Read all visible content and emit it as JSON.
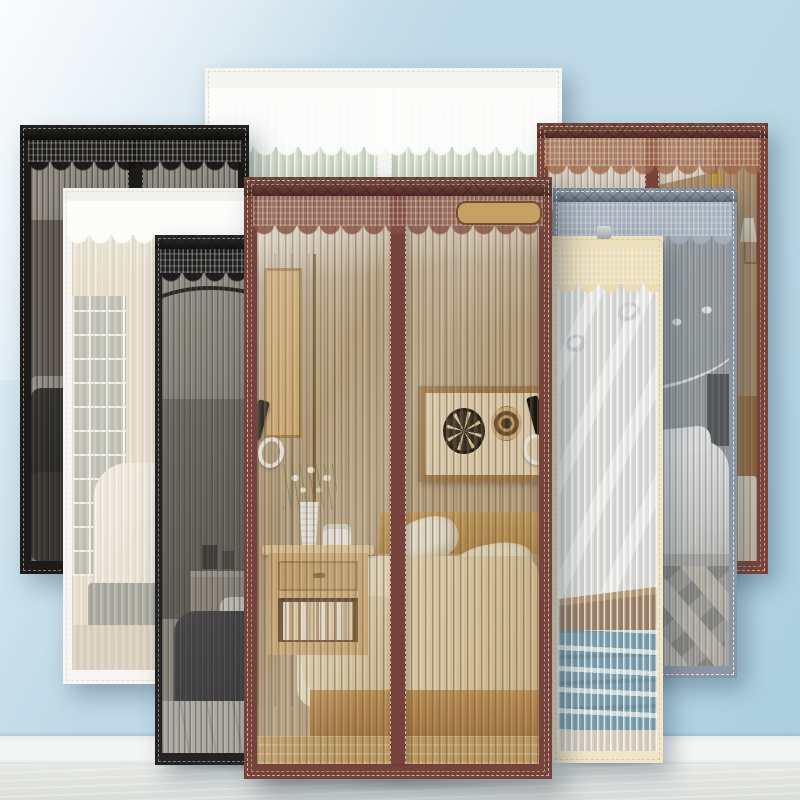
{
  "image_type": "product photo collage",
  "product": {
    "name": "Magnetic lace-trim mesh screen doors shown in multiple colors",
    "variants_shown": [
      "wide white lace",
      "black",
      "white",
      "dark gray",
      "reddish brown",
      "blue gray",
      "beige",
      "coffee brown (front)"
    ]
  },
  "scene": {
    "setting": "light blue wall, white baseboard, pale wood floor",
    "palette": {
      "wall-top": "#ecf3f8",
      "wall": "#bed9e7",
      "wall-deep": "#aacfe0",
      "baseboard": "#f4f6f5",
      "floor": "#e6e8e5"
    }
  },
  "doors": [
    {
      "id": "white-wide",
      "label": "wide white lace screen door",
      "colors": {
        "frame": "#f8f8f6",
        "band": "#f4f4f1",
        "stitch": "rgba(205,205,200,0.55)",
        "lace": "rgba(253,253,252,0.95)",
        "tint": "rgba(255,255,255,0.06)",
        "stripe": "rgba(255,255,255,0.70)",
        "pitch": "8px"
      }
    },
    {
      "id": "black",
      "label": "black screen door",
      "colors": {
        "frame": "#1c1b19",
        "band": "#141311",
        "stitch": "rgba(215,210,200,0.55)",
        "lace": "rgba(20,18,16,0.92)",
        "tint": "rgba(25,22,20,0.30)",
        "stripe": "rgba(8,8,8,0.45)",
        "pitch": "5.5px"
      }
    },
    {
      "id": "white",
      "label": "white screen door",
      "colors": {
        "frame": "#f7f6f2",
        "band": "#f2f1ec",
        "stitch": "rgba(205,205,200,0.5)",
        "lace": "rgba(253,253,251,0.96)",
        "tint": "rgba(247,242,228,0.28)",
        "stripe": "rgba(212,202,174,0.55)",
        "pitch": "7px"
      }
    },
    {
      "id": "dark-gray",
      "label": "dark gray screen door",
      "colors": {
        "frame": "#242321",
        "band": "#1a1918",
        "stitch": "rgba(210,206,198,0.55)",
        "lace": "rgba(22,21,19,0.92)",
        "tint": "rgba(85,82,76,0.22)",
        "stripe": "rgba(35,35,33,0.42)",
        "pitch": "5.5px"
      }
    },
    {
      "id": "red-brown",
      "label": "reddish brown screen door",
      "colors": {
        "frame": "#7b443a",
        "band": "#6e3b33",
        "stitch": "rgba(235,215,185,0.7)",
        "lace": "rgba(158,104,72,0.80)",
        "tint": "rgba(120,90,60,0.14)",
        "stripe": "rgba(85,55,38,0.35)",
        "pitch": "6.5px"
      }
    },
    {
      "id": "blue-gray",
      "label": "blue gray screen door",
      "colors": {
        "frame": "#8b96a5",
        "band": "#8591a0",
        "stitch": "rgba(255,255,255,0.75)",
        "lace": "rgba(167,178,191,0.88)",
        "tint": "rgba(150,158,168,0.18)",
        "stripe": "rgba(70,80,92,0.38)",
        "pitch": "6px"
      }
    },
    {
      "id": "beige",
      "label": "beige screen door",
      "colors": {
        "frame": "#f1e6c8",
        "band": "#ecdfbc",
        "stitch": "rgba(195,180,145,0.5)",
        "lace": "rgba(236,220,182,0.95)",
        "tint": "rgba(240,240,235,0.20)",
        "stripe": "rgba(255,255,255,0.70)",
        "pitch": "6.5px"
      }
    },
    {
      "id": "coffee",
      "label": "coffee brown screen door (front)",
      "colors": {
        "frame": "#76433c",
        "band": "#6a3a34",
        "stitch": "rgba(236,217,188,0.75)",
        "lace": "rgba(132,79,63,0.80)",
        "tint": "rgba(90,65,40,0.08)",
        "stripe": "rgba(95,72,46,0.50)",
        "pitch": "7px"
      }
    }
  ]
}
